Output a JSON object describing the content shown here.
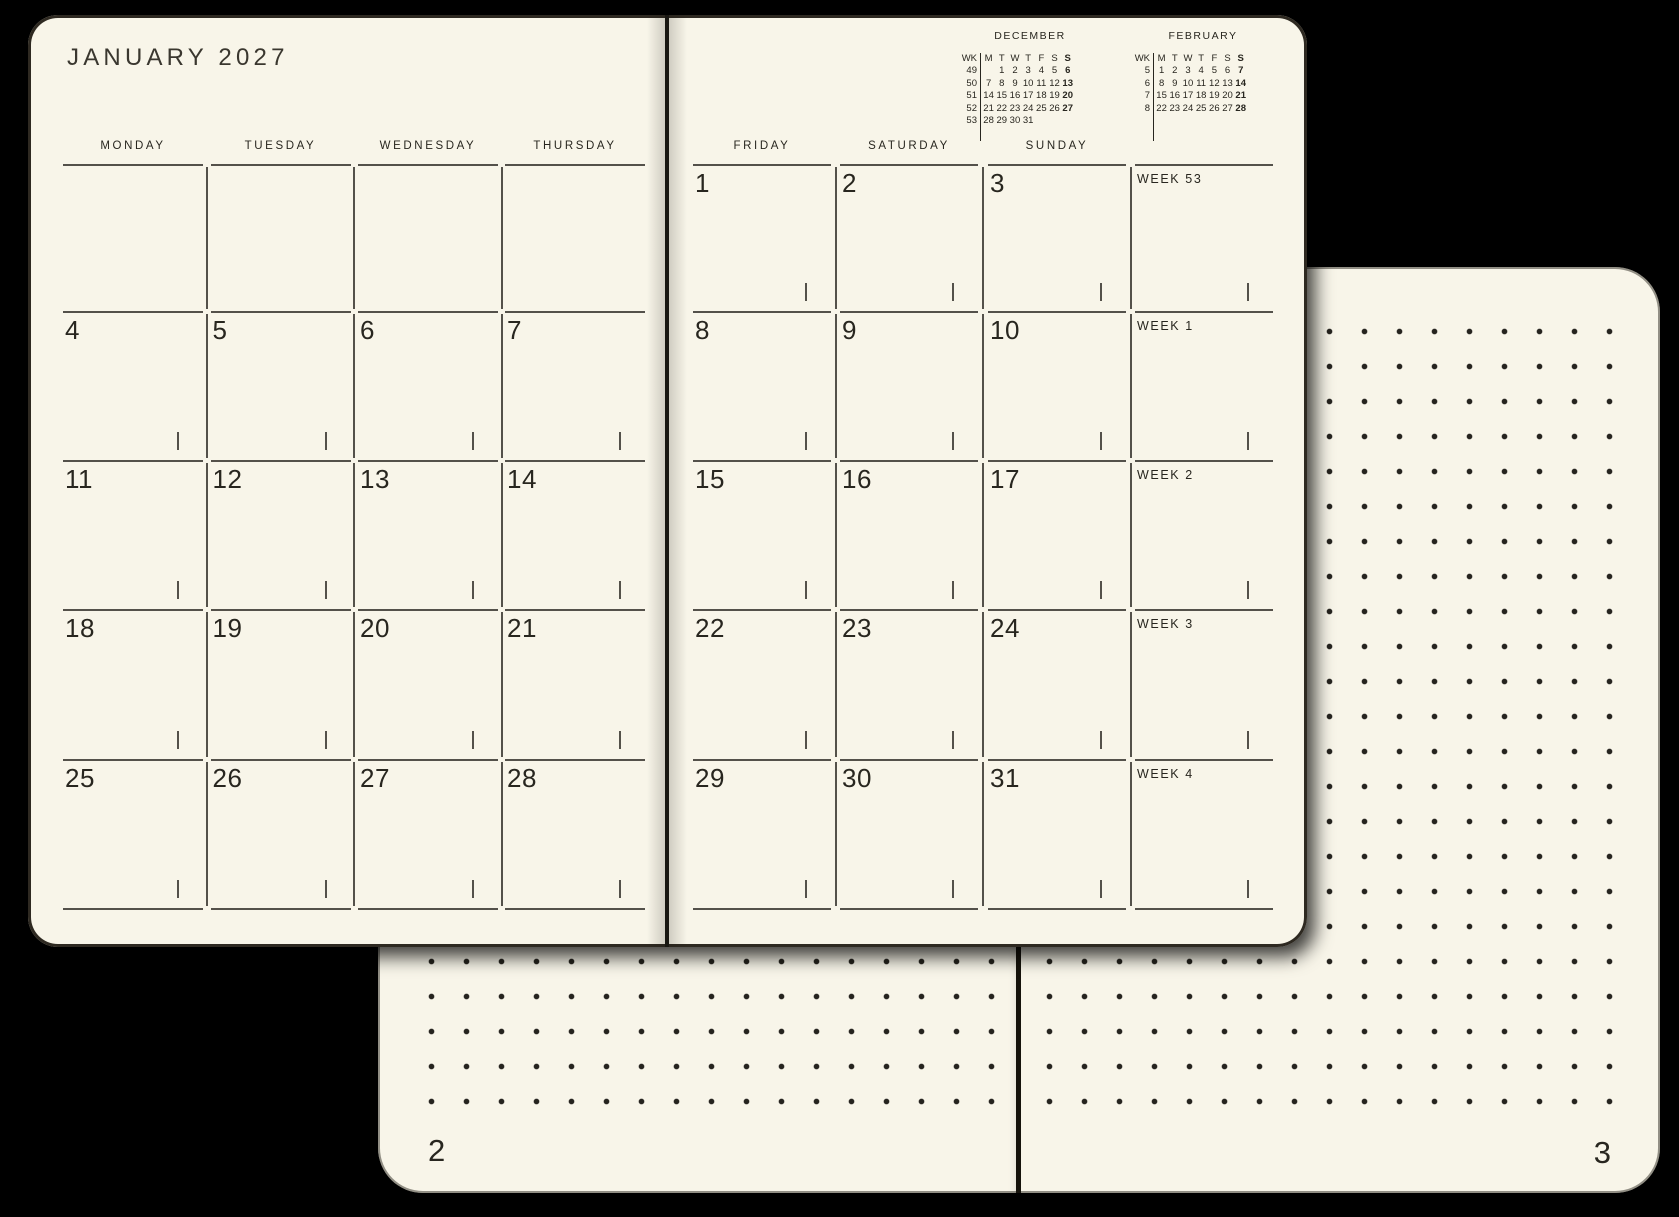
{
  "planner": {
    "front": {
      "left_page": {
        "title": "JANUARY 2027",
        "day_headers": [
          "MONDAY",
          "TUESDAY",
          "WEDNESDAY",
          "THURSDAY"
        ],
        "day_rows": [
          [
            "",
            "",
            "",
            ""
          ],
          [
            "4",
            "5",
            "6",
            "7"
          ],
          [
            "11",
            "12",
            "13",
            "14"
          ],
          [
            "18",
            "19",
            "20",
            "21"
          ],
          [
            "25",
            "26",
            "27",
            "28"
          ]
        ]
      },
      "right_page": {
        "day_headers": [
          "FRIDAY",
          "SATURDAY",
          "SUNDAY"
        ],
        "day_rows": [
          [
            "1",
            "2",
            "3"
          ],
          [
            "8",
            "9",
            "10"
          ],
          [
            "15",
            "16",
            "17"
          ],
          [
            "22",
            "23",
            "24"
          ],
          [
            "29",
            "30",
            "31"
          ]
        ],
        "week_labels": [
          "WEEK 53",
          "WEEK 1",
          "WEEK 2",
          "WEEK 3",
          "WEEK 4"
        ],
        "mini_calendars": [
          {
            "title": "DECEMBER",
            "wk": "WK",
            "dow": [
              "M",
              "T",
              "W",
              "T",
              "F",
              "S",
              "S"
            ],
            "weeks": [
              [
                "49",
                "",
                "1",
                "2",
                "3",
                "4",
                "5",
                "6"
              ],
              [
                "50",
                "7",
                "8",
                "9",
                "10",
                "11",
                "12",
                "13"
              ],
              [
                "51",
                "14",
                "15",
                "16",
                "17",
                "18",
                "19",
                "20"
              ],
              [
                "52",
                "21",
                "22",
                "23",
                "24",
                "25",
                "26",
                "27"
              ],
              [
                "53",
                "28",
                "29",
                "30",
                "31",
                "",
                "",
                ""
              ]
            ]
          },
          {
            "title": "FEBRUARY",
            "wk": "WK",
            "dow": [
              "M",
              "T",
              "W",
              "T",
              "F",
              "S",
              "S"
            ],
            "weeks": [
              [
                "5",
                "1",
                "2",
                "3",
                "4",
                "5",
                "6",
                "7"
              ],
              [
                "6",
                "8",
                "9",
                "10",
                "11",
                "12",
                "13",
                "14"
              ],
              [
                "7",
                "15",
                "16",
                "17",
                "18",
                "19",
                "20",
                "21"
              ],
              [
                "8",
                "22",
                "23",
                "24",
                "25",
                "26",
                "27",
                "28"
              ]
            ]
          }
        ]
      }
    },
    "back": {
      "left_page_number": "2",
      "right_page_number": "3"
    }
  },
  "colors": {
    "background": "#000000",
    "paper": "#f8f5e9",
    "ink": "#28261f",
    "line": "#54514a",
    "dot": "#25231e",
    "edge": "#16130c",
    "title_ink": "#3a372f"
  }
}
